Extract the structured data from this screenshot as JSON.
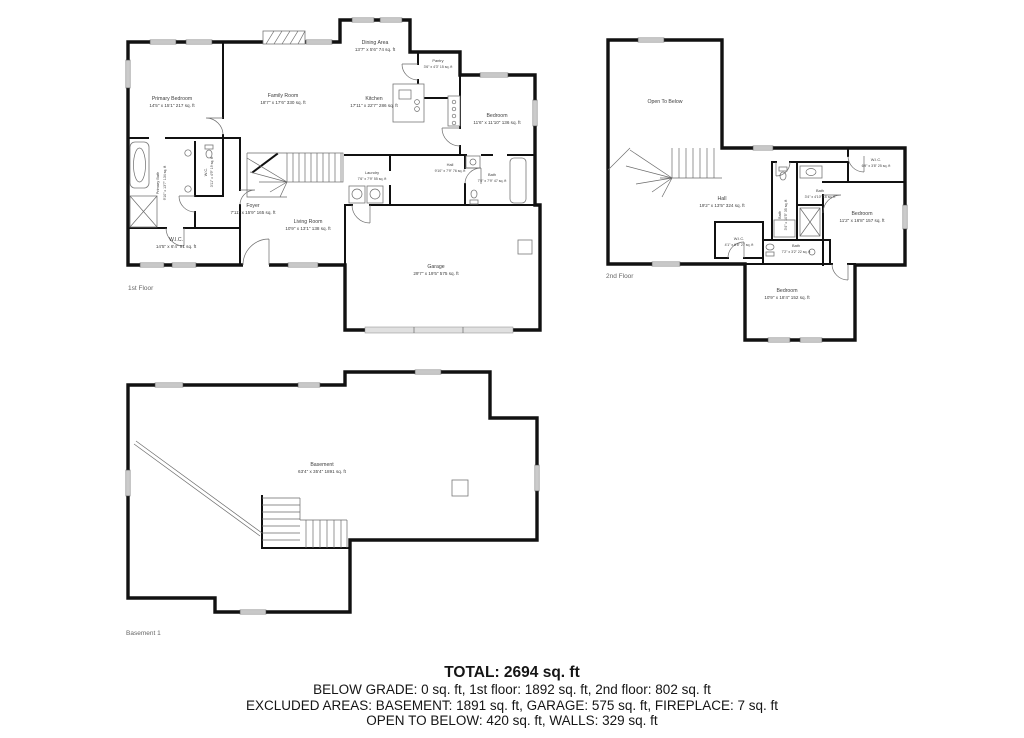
{
  "captions": {
    "first": "1st Floor",
    "second": "2nd Floor",
    "basement": "Basement 1"
  },
  "floor1": {
    "primary_bedroom": {
      "name": "Primary Bedroom",
      "dims": "14'5\" x 15'1\" 217 sq. ft"
    },
    "family_room": {
      "name": "Family Room",
      "dims": "18'7\" x 17'6\" 330 sq. ft"
    },
    "dining_area": {
      "name": "Dining Area",
      "dims": "13'7\" x 5'6\" 74 sq. ft"
    },
    "pantry": {
      "name": "Pantry",
      "dims": "3'6\" x 4'3\" 15 sq. ft"
    },
    "kitchen": {
      "name": "Kitchen",
      "dims": "17'11\" x 22'7\" 286 sq. ft"
    },
    "bedroom": {
      "name": "Bedroom",
      "dims": "11'6\" x 11'10\" 136 sq. ft"
    },
    "primary_bath": {
      "name": "Primary Bath",
      "dims": "9'10\" x 13'7\" 134 sq. ft"
    },
    "wc": {
      "name": "W.C.",
      "dims": "3'11\" x 4'9\" 19 sq. ft"
    },
    "laundry": {
      "name": "Laundry",
      "dims": "7'6\" x 7'9\" 55 sq. ft"
    },
    "hall": {
      "name": "Hall",
      "dims": "9'10\" x 7'9\" 76 sq. ft"
    },
    "bath": {
      "name": "Bath",
      "dims": "7'0\" x 7'9\" 47 sq. ft"
    },
    "foyer": {
      "name": "Foyer",
      "dims": "7'11\" x 15'9\" 165 sq. ft"
    },
    "living_room": {
      "name": "Living Room",
      "dims": "10'9\" x 13'1\" 138 sq. ft"
    },
    "wic": {
      "name": "W.I.C.",
      "dims": "14'5\" x 6'4\" 91 sq. ft"
    },
    "garage": {
      "name": "Garage",
      "dims": "29'7\" x 19'5\" 575 sq. ft"
    }
  },
  "floor2": {
    "open_to_below": {
      "name": "Open To Below"
    },
    "hall": {
      "name": "Hall",
      "dims": "19'2\" x 13'5\" 324 sq. ft"
    },
    "wic_top": {
      "name": "W.I.C.",
      "dims": "6'9\" x 3'8\" 25 sq. ft"
    },
    "bath_small": {
      "name": "Bath",
      "dims": "3'4\" x 4'10\" 16 sq. ft"
    },
    "bedroom_right": {
      "name": "Bedroom",
      "dims": "11'2\" x 16'8\" 157 sq. ft"
    },
    "bath_mid": {
      "name": "Bath",
      "dims": "3'4\" x 10'5\" 35 sq. ft"
    },
    "wic_bottom": {
      "name": "W.I.C.",
      "dims": "4'1\" x 6'8\" 27 sq. ft"
    },
    "bath_bottom": {
      "name": "Bath",
      "dims": "7'2\" x 3'2\" 22 sq. ft"
    },
    "bedroom_bottom": {
      "name": "Bedroom",
      "dims": "10'9\" x 18'4\" 152 sq. ft"
    }
  },
  "basement": {
    "room": {
      "name": "Basement",
      "dims": "63'4\" x 35'4\" 1891 sq. ft"
    }
  },
  "summary": {
    "total": "TOTAL: 2694 sq. ft",
    "line1": "BELOW GRADE: 0 sq. ft, 1st floor: 1892 sq. ft, 2nd floor: 802 sq. ft",
    "line2": "EXCLUDED AREAS: BASEMENT: 1891 sq. ft, GARAGE: 575 sq. ft, FIREPLACE: 7 sq. ft",
    "line3": "OPEN TO BELOW: 420 sq. ft, WALLS: 329 sq. ft"
  }
}
